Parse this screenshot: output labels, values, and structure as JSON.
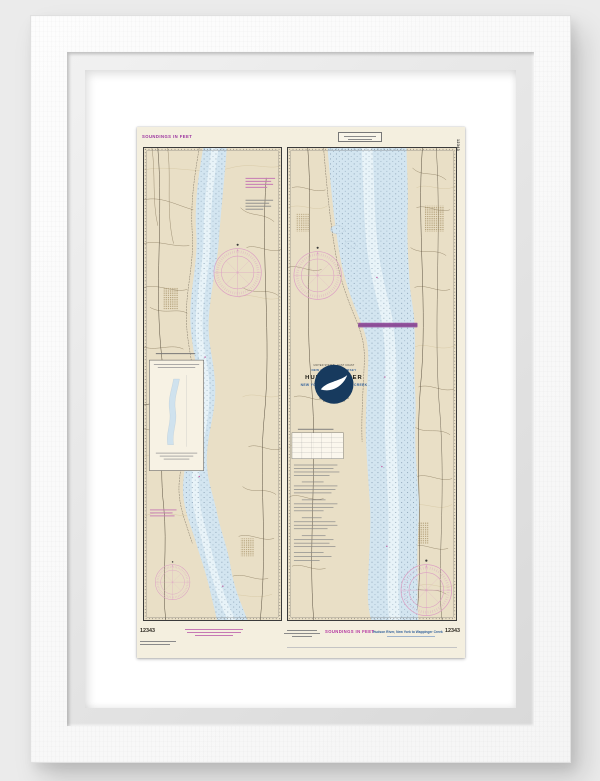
{
  "page": {
    "background": "#ebebeb"
  },
  "frame": {
    "frame_color": "#fbfbfb",
    "mat_color": "#ffffff"
  },
  "chart": {
    "number": "12343",
    "paper_color": "#f4efdf",
    "land_color": "#e9dfc6",
    "water_color": "#d3e5f0",
    "accent_magenta": "#c0569f",
    "bridge_color": "#8e4a99",
    "blue_text_color": "#35639c",
    "purple_text_color": "#9a2f9e",
    "top": {
      "soundings_note": "SOUNDINGS IN FEET",
      "side_number": "12343"
    },
    "title_block": {
      "country_line": "UNITED STATES - EAST COAST",
      "region_line": "NEW YORK - NEW JERSEY",
      "title": "HUDSON RIVER",
      "subtitle": "NEW YORK TO WAPPINGER CREEK",
      "detail_line_1": "Mercator Projection",
      "detail_line_2": "Scale 1:40,000",
      "detail_line_3": "North American Datum of 1983",
      "detail_line_4": "SOUNDINGS IN FEET"
    },
    "bottom": {
      "number_left": "12343",
      "soundings_label": "SOUNDINGS IN FEET",
      "title_label": "Hudson River, New York to Wappinger Creek",
      "number_right": "12343"
    }
  }
}
